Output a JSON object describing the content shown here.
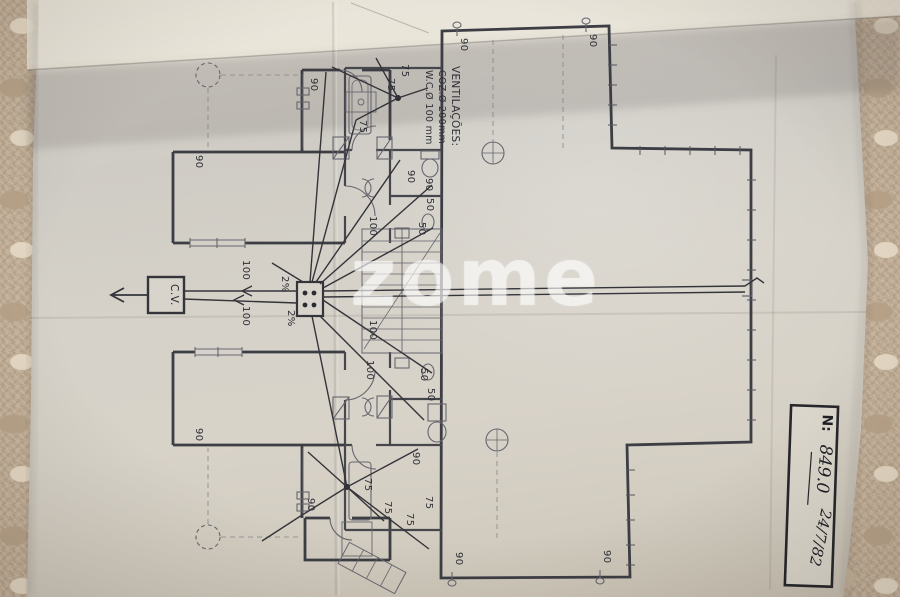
{
  "watermark": {
    "text": "zome"
  },
  "stamp": {
    "prefix": "N:",
    "number": "849.0",
    "date": "24/7/82"
  },
  "ventilation_note": {
    "title": "VENTILAÇÕES:",
    "coz": "COZ.Ø 200mm",
    "wc": "W.C.Ø 100 mm"
  },
  "cv_box": {
    "label": "C.V."
  },
  "pipe_labels": {
    "d100": [
      "100",
      "100",
      "100",
      "100",
      "100"
    ],
    "d90": [
      "90",
      "90",
      "90",
      "90",
      "90",
      "90",
      "90",
      "90",
      "90",
      "90",
      "90"
    ],
    "d75": [
      "75",
      "75",
      "75",
      "75",
      "75",
      "75",
      "75"
    ],
    "d50": [
      "50",
      "50",
      "50",
      "50"
    ],
    "slope": [
      "2%",
      "2%"
    ]
  },
  "colors": {
    "fabric": "#c2ae96",
    "paper": "#d7d2c8",
    "paper_bright": "#ebe6db",
    "ink": "#33343a",
    "plan_line": "#55555c",
    "watermark": "#ffffff"
  }
}
